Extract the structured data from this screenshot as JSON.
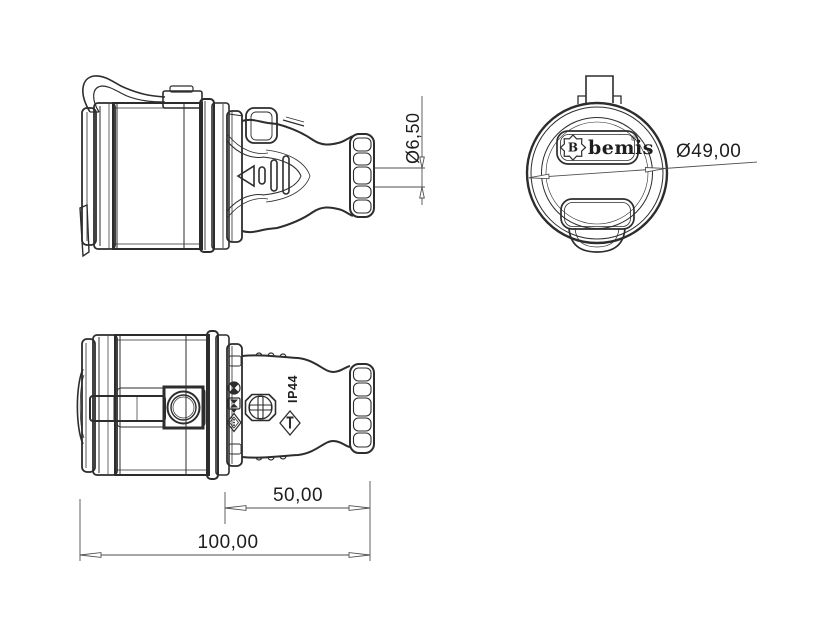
{
  "colors": {
    "background": "#ffffff",
    "outline": "#2d2d2d",
    "dimension_lines": "#4f4f4f",
    "text": "#1e1e1e"
  },
  "views": {
    "side_view": {
      "dimension_cable_entry": "Ø6,50"
    },
    "front_view": {
      "logo": {
        "initial": "B",
        "brand": "bemis",
        "mark": "®"
      },
      "dimension_diameter": "Ø49,00"
    },
    "top_view": {
      "ip_rating": "IP44",
      "dimension_front_section": "50,00",
      "dimension_overall": "100,00"
    }
  },
  "icons": {
    "cert_1": "circle-cross-approval-icon",
    "cert_2": "hourglass-approval-icon",
    "cert_3": "diamond-approval-icon",
    "screw": "phillips-screw-icon",
    "warning": "diamond-tool-icon",
    "triangle": "triangle-marker-icon"
  }
}
